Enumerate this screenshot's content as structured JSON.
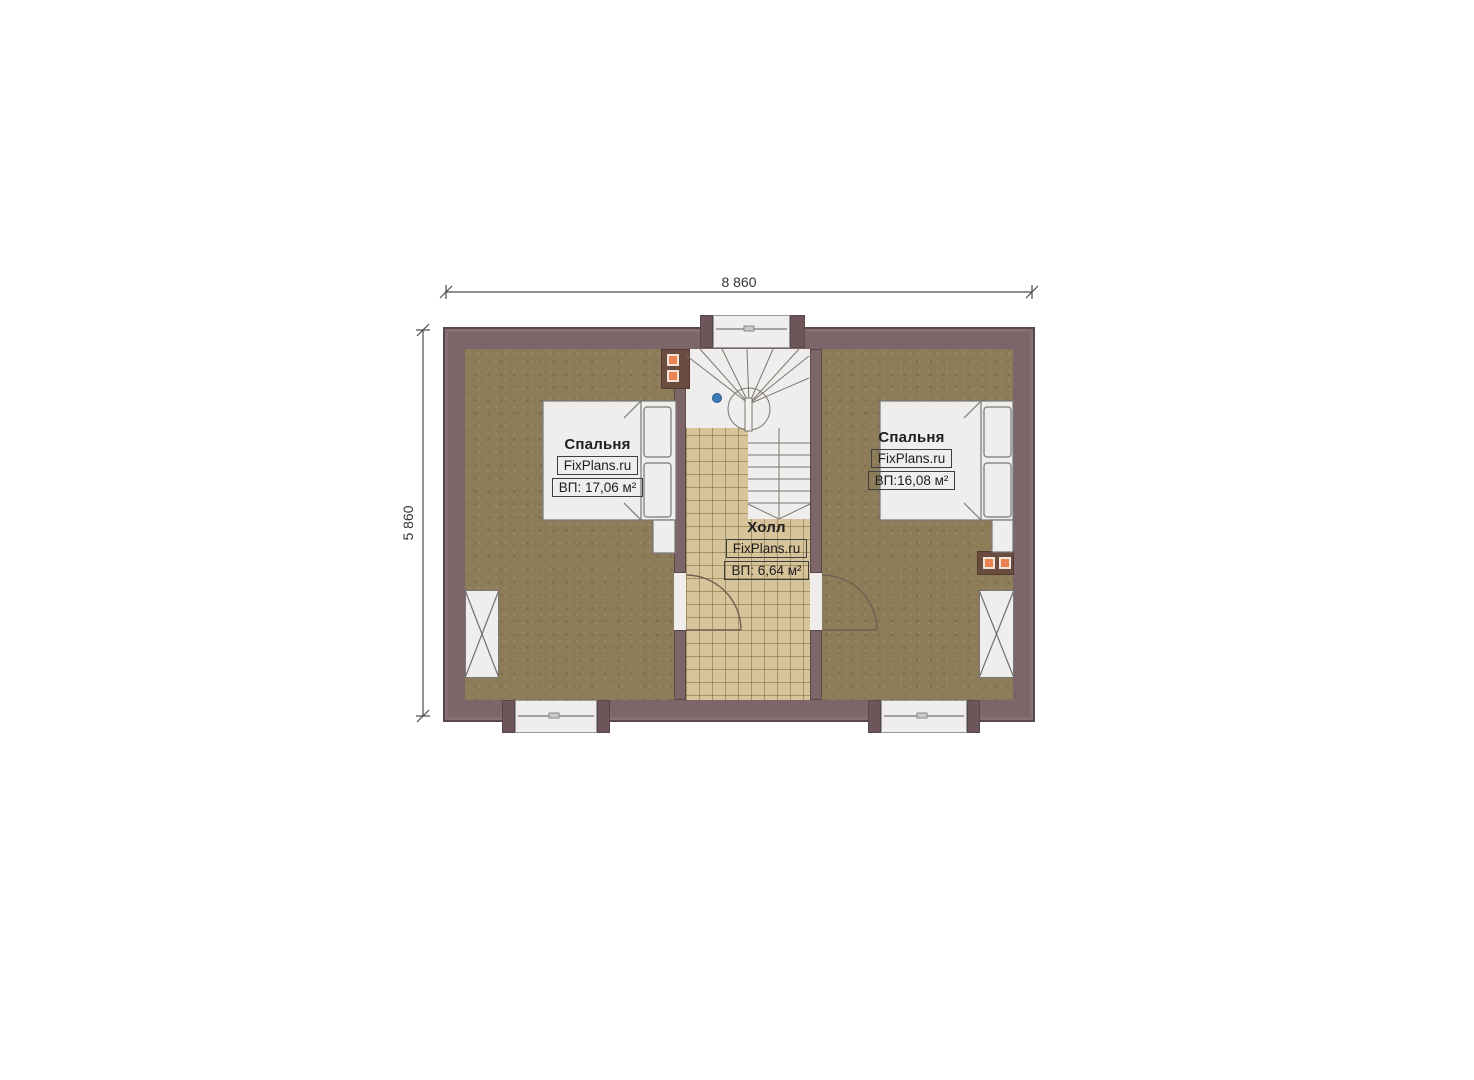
{
  "plan": {
    "type": "floor-plan",
    "floor_note": "attic level with stair, two bedrooms and hall"
  },
  "dimensions": {
    "width_label": "8 860",
    "height_label": "5 860"
  },
  "rooms": {
    "bedroom_left": {
      "name": "Спальня",
      "brand": "FixPlans.ru",
      "area": "ВП: 17,06 м²"
    },
    "bedroom_right": {
      "name": "Спальня",
      "brand": "FixPlans.ru",
      "area": "ВП:16,08 м²"
    },
    "hall": {
      "name": "Холл",
      "brand": "FixPlans.ru",
      "area": "ВП: 6,64 м²"
    }
  },
  "colors": {
    "wall": "#7c666a",
    "wall_dark": "#5a474a",
    "floor": "#8d7c58",
    "tile": "#d8c49a",
    "white": "#efeeec",
    "accent_orange": "#e8824e",
    "flue_block": "#6b4c41",
    "marker_blue": "#3f7ab8"
  }
}
